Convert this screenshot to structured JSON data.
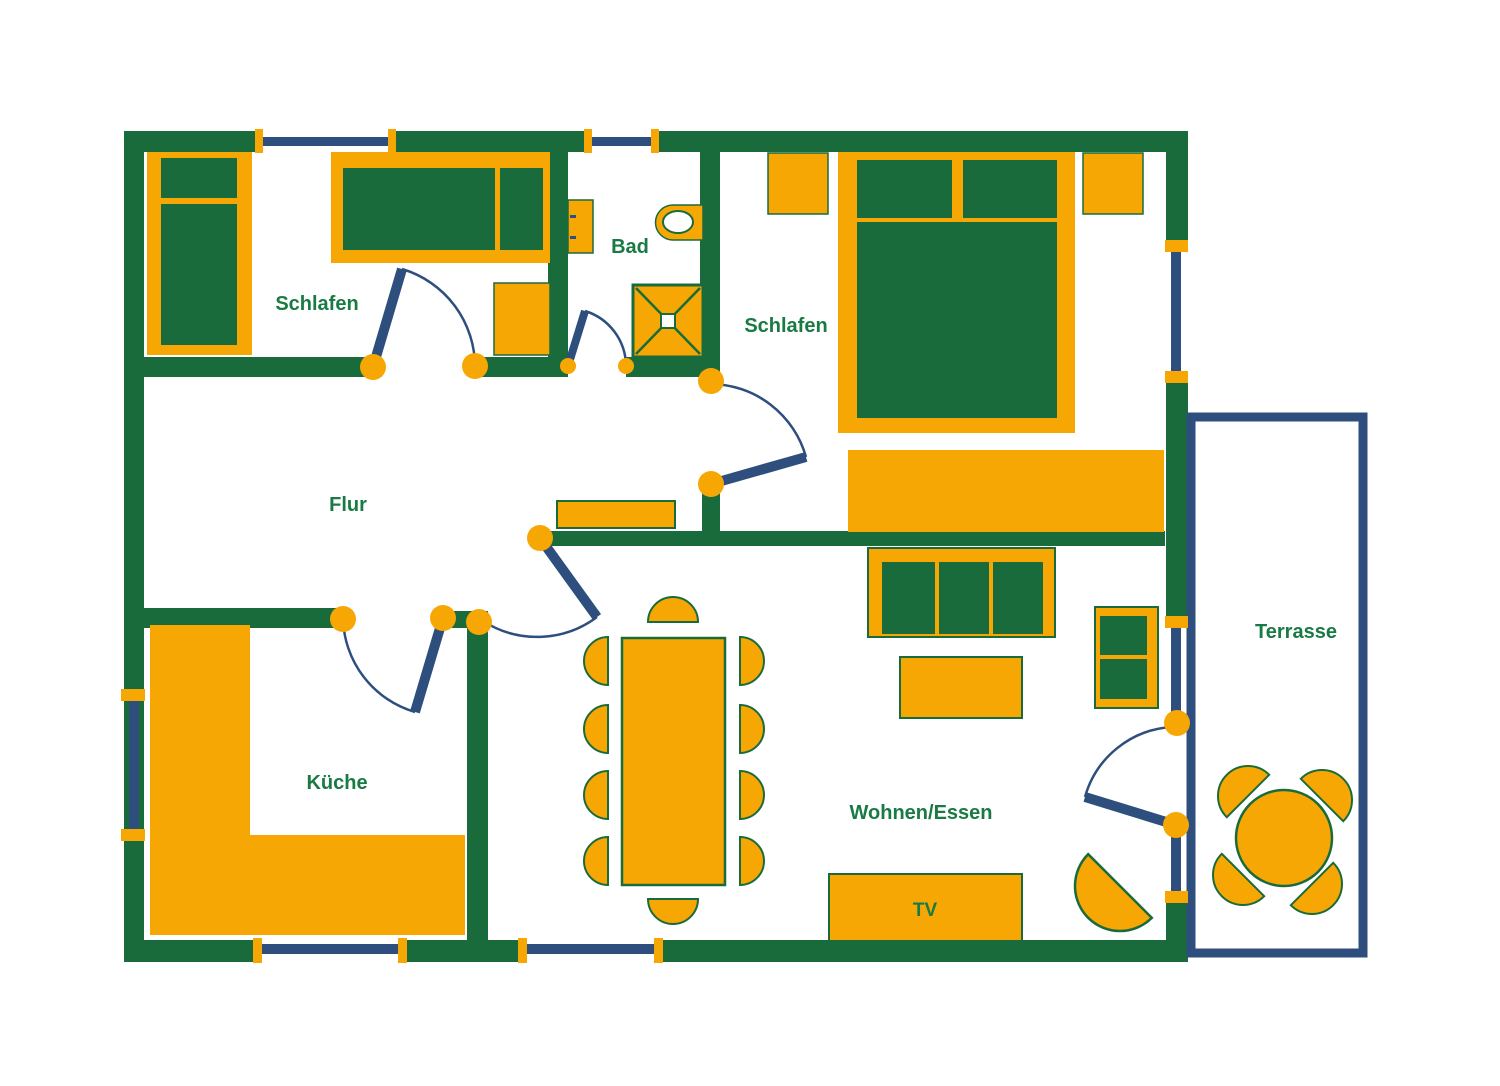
{
  "colors": {
    "wall": "#1A6B3C",
    "text": "#1A7A44",
    "furniture": "#F6A704",
    "window": "#2E4F7E",
    "background": "#FFFFFF"
  },
  "rooms": [
    {
      "name": "schlafen-1",
      "label": "Schlafen",
      "x": 317,
      "y": 310
    },
    {
      "name": "bad",
      "label": "Bad",
      "x": 630,
      "y": 253
    },
    {
      "name": "schlafen-2",
      "label": "Schlafen",
      "x": 786,
      "y": 332
    },
    {
      "name": "flur",
      "label": "Flur",
      "x": 348,
      "y": 511
    },
    {
      "name": "kueche",
      "label": "Küche",
      "x": 337,
      "y": 789
    },
    {
      "name": "wohnen-essen",
      "label": "Wohnen/Essen",
      "x": 921,
      "y": 819
    },
    {
      "name": "terrasse",
      "label": "Terrasse",
      "x": 1296,
      "y": 638
    },
    {
      "name": "tv",
      "label": "TV",
      "x": 925,
      "y": 916,
      "size": 19
    }
  ],
  "walls": [
    {
      "name": "wall-top-1",
      "x": 124,
      "y": 131,
      "w": 131,
      "h": 21
    },
    {
      "name": "wall-top-2",
      "x": 396,
      "y": 131,
      "w": 188,
      "h": 21
    },
    {
      "name": "wall-top-3",
      "x": 659,
      "y": 131,
      "w": 529,
      "h": 21
    },
    {
      "name": "wall-left",
      "x": 124,
      "y": 131,
      "w": 20,
      "h": 831
    },
    {
      "name": "wall-right-1",
      "x": 1166,
      "y": 131,
      "w": 22,
      "h": 109
    },
    {
      "name": "wall-right-2",
      "x": 1166,
      "y": 382,
      "w": 22,
      "h": 234
    },
    {
      "name": "wall-right-3",
      "x": 1166,
      "y": 902,
      "w": 22,
      "h": 60
    },
    {
      "name": "wall-bottom-1",
      "x": 124,
      "y": 940,
      "w": 132,
      "h": 22
    },
    {
      "name": "wall-bottom-2",
      "x": 404,
      "y": 940,
      "w": 116,
      "h": 22
    },
    {
      "name": "wall-bottom-3",
      "x": 661,
      "y": 940,
      "w": 527,
      "h": 22
    },
    {
      "name": "wall-bath-left",
      "x": 548,
      "y": 152,
      "w": 20,
      "h": 225
    },
    {
      "name": "wall-bath-right",
      "x": 700,
      "y": 152,
      "w": 20,
      "h": 229
    },
    {
      "name": "wall-schlafen1-bottom-1",
      "x": 144,
      "y": 357,
      "w": 229,
      "h": 20
    },
    {
      "name": "wall-schlafen1-bottom-2",
      "x": 475,
      "y": 357,
      "w": 93,
      "h": 20
    },
    {
      "name": "wall-bad-bottom",
      "x": 626,
      "y": 357,
      "w": 74,
      "h": 20
    },
    {
      "name": "wall-schlafen2-stub",
      "x": 702,
      "y": 488,
      "w": 18,
      "h": 44
    },
    {
      "name": "wall-flur-wohnen",
      "x": 545,
      "y": 531,
      "w": 620,
      "h": 15
    },
    {
      "name": "wall-kueche-top-1",
      "x": 144,
      "y": 608,
      "w": 199,
      "h": 20
    },
    {
      "name": "wall-kueche-top-2",
      "x": 443,
      "y": 611,
      "w": 45,
      "h": 17
    },
    {
      "name": "wall-kueche-right",
      "x": 467,
      "y": 611,
      "w": 21,
      "h": 329
    }
  ],
  "terrace_outline": {
    "name": "terrasse-outline",
    "x": 1191,
    "y": 417,
    "w": 172,
    "h": 536,
    "sw": 9
  },
  "windows": [
    {
      "name": "window-top-schlafen1",
      "caps": [
        [
          255,
          129,
          8,
          24
        ],
        [
          388,
          129,
          8,
          24
        ]
      ],
      "line": [
        263,
        137,
        125,
        9
      ]
    },
    {
      "name": "window-top-bad",
      "caps": [
        [
          584,
          129,
          8,
          24
        ],
        [
          651,
          129,
          8,
          24
        ]
      ],
      "line": [
        592,
        137,
        59,
        9
      ]
    },
    {
      "name": "window-left-kueche",
      "caps": [
        [
          121,
          689,
          24,
          12
        ],
        [
          121,
          829,
          24,
          12
        ]
      ],
      "line": [
        129,
        701,
        10,
        128
      ]
    },
    {
      "name": "window-right-schlafen2",
      "caps": [
        [
          1165,
          240,
          23,
          12
        ],
        [
          1165,
          371,
          23,
          12
        ]
      ],
      "line": [
        1171,
        252,
        10,
        119
      ]
    },
    {
      "name": "window-right-wohnen-upper",
      "caps": [
        [
          1165,
          616,
          23,
          12
        ]
      ],
      "line": [
        1171,
        628,
        10,
        88
      ]
    },
    {
      "name": "window-right-wohnen-lower",
      "caps": [
        [
          1165,
          891,
          23,
          12
        ]
      ],
      "line": [
        1171,
        833,
        10,
        58
      ]
    },
    {
      "name": "window-bottom-kueche",
      "caps": [
        [
          253,
          938,
          9,
          25
        ],
        [
          398,
          938,
          9,
          25
        ]
      ],
      "line": [
        262,
        944,
        136,
        10
      ]
    },
    {
      "name": "window-bottom-wohnen",
      "caps": [
        [
          518,
          938,
          9,
          25
        ],
        [
          654,
          938,
          9,
          25
        ]
      ],
      "line": [
        527,
        944,
        127,
        10
      ]
    }
  ],
  "doors": [
    {
      "name": "door-schlafen1",
      "leaf": [
        373,
        367,
        402,
        269
      ],
      "arc": "M 402 269 A 102 102 0 0 1 475 367",
      "circles": [
        [
          373,
          367,
          13
        ],
        [
          475,
          366,
          13
        ]
      ],
      "lw": 10
    },
    {
      "name": "door-bad",
      "leaf": [
        568,
        366,
        585,
        311
      ],
      "arc": "M 585 311 A 58 58 0 0 1 626 366",
      "circles": [
        [
          568,
          366,
          8
        ],
        [
          626,
          366,
          8
        ]
      ],
      "lw": 8
    },
    {
      "name": "door-schlafen2",
      "leaf": [
        711,
        484,
        806,
        457
      ],
      "arc": "M 711 384 A 100 100 0 0 1 806 457",
      "circles": [
        [
          711,
          381,
          13
        ],
        [
          711,
          484,
          13
        ]
      ],
      "lw": 10
    },
    {
      "name": "door-kueche",
      "leaf": [
        443,
        618,
        415,
        712
      ],
      "arc": "M 343 618 A 100 100 0 0 0 415 712",
      "circles": [
        [
          343,
          619,
          13
        ],
        [
          443,
          618,
          13
        ]
      ],
      "lw": 10
    },
    {
      "name": "door-flur-wohnen",
      "leaf": [
        540,
        538,
        597,
        617
      ],
      "arc": "M 597 617 A 100 100 0 0 1 483 621",
      "circles": [
        [
          540,
          538,
          13
        ],
        [
          479,
          622,
          13
        ]
      ],
      "lw": 10
    },
    {
      "name": "door-terrasse",
      "leaf": [
        1176,
        825,
        1085,
        797
      ],
      "arc": "M 1085 797 A 96 96 0 0 1 1172 727",
      "circles": [
        [
          1177,
          723,
          13
        ],
        [
          1176,
          825,
          13
        ]
      ],
      "lw": 10
    }
  ],
  "furniture": [
    {
      "name": "wardrobe",
      "type": "rect",
      "x": 147,
      "y": 152,
      "w": 105,
      "h": 203,
      "fill": "furniture"
    },
    {
      "name": "wardrobe-door-top",
      "type": "rect",
      "x": 161,
      "y": 158,
      "w": 76,
      "h": 40,
      "fill": "wall"
    },
    {
      "name": "wardrobe-door-bottom",
      "type": "rect",
      "x": 161,
      "y": 204,
      "w": 76,
      "h": 141,
      "fill": "wall"
    },
    {
      "name": "bed-single-frame",
      "type": "rect",
      "x": 331,
      "y": 152,
      "w": 219,
      "h": 111,
      "fill": "furniture"
    },
    {
      "name": "bed-single-mattress",
      "type": "rect",
      "x": 343,
      "y": 168,
      "w": 152,
      "h": 82,
      "fill": "wall"
    },
    {
      "name": "bed-single-pillow",
      "type": "rect",
      "x": 500,
      "y": 168,
      "w": 43,
      "h": 82,
      "fill": "wall"
    },
    {
      "name": "nightstand-schlafen1",
      "type": "rect",
      "x": 494,
      "y": 283,
      "w": 56,
      "h": 72,
      "fill": "furniture",
      "stroke": "wall",
      "sw": 1.5
    },
    {
      "name": "bath-sink",
      "type": "rect",
      "x": 568,
      "y": 200,
      "w": 25,
      "h": 53,
      "fill": "furniture",
      "stroke": "wall",
      "sw": 1.5
    },
    {
      "name": "bath-sink-handle-1",
      "type": "rect",
      "x": 570,
      "y": 215,
      "w": 6,
      "h": 3,
      "fill": "window"
    },
    {
      "name": "bath-sink-handle-2",
      "type": "rect",
      "x": 570,
      "y": 236,
      "w": 6,
      "h": 3,
      "fill": "window"
    },
    {
      "name": "toilet",
      "type": "path",
      "d": "M 703 205 L 673 205 A 17.5 17.5 0 0 0 673 240 L 703 240 Z",
      "fill": "furniture",
      "stroke": "wall",
      "sw": 1.5
    },
    {
      "name": "toilet-bowl",
      "type": "ellipse",
      "cx": 678,
      "cy": 222,
      "rx": 15,
      "ry": 11,
      "fill": "background",
      "stroke": "wall",
      "sw": 2
    },
    {
      "name": "shower",
      "type": "rect",
      "x": 633,
      "y": 285,
      "w": 70,
      "h": 72,
      "fill": "furniture",
      "stroke": "wall",
      "sw": 3
    },
    {
      "name": "shower-diagonal-1",
      "type": "line",
      "x1": 636,
      "y1": 288,
      "x2": 700,
      "y2": 354,
      "stroke": "wall",
      "sw": 2.5
    },
    {
      "name": "shower-diagonal-2",
      "type": "line",
      "x1": 700,
      "y1": 288,
      "x2": 636,
      "y2": 354,
      "stroke": "wall",
      "sw": 2.5
    },
    {
      "name": "shower-drain",
      "type": "rect",
      "x": 661,
      "y": 314,
      "w": 14,
      "h": 14,
      "fill": "background",
      "stroke": "wall",
      "sw": 2
    },
    {
      "name": "nightstand-schlafen2-left",
      "type": "rect",
      "x": 768,
      "y": 153,
      "w": 60,
      "h": 61,
      "fill": "furniture",
      "stroke": "wall",
      "sw": 1.5
    },
    {
      "name": "nightstand-schlafen2-right",
      "type": "rect",
      "x": 1083,
      "y": 153,
      "w": 60,
      "h": 61,
      "fill": "furniture",
      "stroke": "wall",
      "sw": 1.5
    },
    {
      "name": "bed-double-frame",
      "type": "rect",
      "x": 838,
      "y": 152,
      "w": 237,
      "h": 281,
      "fill": "furniture"
    },
    {
      "name": "bed-double-pillow-left",
      "type": "rect",
      "x": 857,
      "y": 160,
      "w": 95,
      "h": 58,
      "fill": "wall"
    },
    {
      "name": "bed-double-pillow-right",
      "type": "rect",
      "x": 963,
      "y": 160,
      "w": 94,
      "h": 58,
      "fill": "wall"
    },
    {
      "name": "bed-double-mattress",
      "type": "rect",
      "x": 857,
      "y": 222,
      "w": 200,
      "h": 196,
      "fill": "wall"
    },
    {
      "name": "dresser-schlafen2",
      "type": "rect",
      "x": 848,
      "y": 450,
      "w": 316,
      "h": 82,
      "fill": "furniture"
    },
    {
      "name": "sideboard-flur",
      "type": "rect",
      "x": 557,
      "y": 501,
      "w": 118,
      "h": 27,
      "fill": "furniture",
      "stroke": "wall",
      "sw": 2
    },
    {
      "name": "kitchen-counter-left",
      "type": "rect",
      "x": 150,
      "y": 625,
      "w": 100,
      "h": 310,
      "fill": "furniture"
    },
    {
      "name": "kitchen-counter-bottom",
      "type": "rect",
      "x": 150,
      "y": 835,
      "w": 315,
      "h": 100,
      "fill": "furniture"
    },
    {
      "name": "dining-table",
      "type": "rect",
      "x": 622,
      "y": 638,
      "w": 103,
      "h": 247,
      "fill": "furniture",
      "stroke": "wall",
      "sw": 2.5
    },
    {
      "name": "dining-chair-top",
      "type": "semicircle",
      "cx": 673,
      "cy": 622,
      "r": 25,
      "rot": 0,
      "fill": "furniture",
      "stroke": "wall",
      "sw": 2
    },
    {
      "name": "dining-chair-bottom",
      "type": "semicircle",
      "cx": 673,
      "cy": 899,
      "r": 25,
      "rot": 180,
      "fill": "furniture",
      "stroke": "wall",
      "sw": 2
    },
    {
      "name": "dining-chair-left-1",
      "type": "semicircle",
      "cx": 608,
      "cy": 661,
      "r": 24,
      "rot": -90,
      "fill": "furniture",
      "stroke": "wall",
      "sw": 2
    },
    {
      "name": "dining-chair-left-2",
      "type": "semicircle",
      "cx": 608,
      "cy": 729,
      "r": 24,
      "rot": -90,
      "fill": "furniture",
      "stroke": "wall",
      "sw": 2
    },
    {
      "name": "dining-chair-left-3",
      "type": "semicircle",
      "cx": 608,
      "cy": 795,
      "r": 24,
      "rot": -90,
      "fill": "furniture",
      "stroke": "wall",
      "sw": 2
    },
    {
      "name": "dining-chair-left-4",
      "type": "semicircle",
      "cx": 608,
      "cy": 861,
      "r": 24,
      "rot": -90,
      "fill": "furniture",
      "stroke": "wall",
      "sw": 2
    },
    {
      "name": "dining-chair-right-1",
      "type": "semicircle",
      "cx": 740,
      "cy": 661,
      "r": 24,
      "rot": 90,
      "fill": "furniture",
      "stroke": "wall",
      "sw": 2
    },
    {
      "name": "dining-chair-right-2",
      "type": "semicircle",
      "cx": 740,
      "cy": 729,
      "r": 24,
      "rot": 90,
      "fill": "furniture",
      "stroke": "wall",
      "sw": 2
    },
    {
      "name": "dining-chair-right-3",
      "type": "semicircle",
      "cx": 740,
      "cy": 795,
      "r": 24,
      "rot": 90,
      "fill": "furniture",
      "stroke": "wall",
      "sw": 2
    },
    {
      "name": "dining-chair-right-4",
      "type": "semicircle",
      "cx": 740,
      "cy": 861,
      "r": 24,
      "rot": 90,
      "fill": "furniture",
      "stroke": "wall",
      "sw": 2
    },
    {
      "name": "sofa-frame",
      "type": "rect",
      "x": 868,
      "y": 548,
      "w": 187,
      "h": 89,
      "fill": "furniture",
      "stroke": "wall",
      "sw": 2
    },
    {
      "name": "sofa-seat",
      "type": "rect",
      "x": 882,
      "y": 562,
      "w": 161,
      "h": 72,
      "fill": "wall"
    },
    {
      "name": "sofa-divider-1",
      "type": "rect",
      "x": 935,
      "y": 562,
      "w": 4,
      "h": 72,
      "fill": "furniture"
    },
    {
      "name": "sofa-divider-2",
      "type": "rect",
      "x": 989,
      "y": 562,
      "w": 4,
      "h": 72,
      "fill": "furniture"
    },
    {
      "name": "coffee-table",
      "type": "rect",
      "x": 900,
      "y": 657,
      "w": 122,
      "h": 61,
      "fill": "furniture",
      "stroke": "wall",
      "sw": 2
    },
    {
      "name": "armchair-frame",
      "type": "rect",
      "x": 1095,
      "y": 607,
      "w": 63,
      "h": 101,
      "fill": "furniture",
      "stroke": "wall",
      "sw": 2
    },
    {
      "name": "armchair-seat",
      "type": "rect",
      "x": 1100,
      "y": 616,
      "w": 47,
      "h": 83,
      "fill": "wall"
    },
    {
      "name": "armchair-divider",
      "type": "rect",
      "x": 1100,
      "y": 655,
      "w": 47,
      "h": 4,
      "fill": "furniture"
    },
    {
      "name": "tv-board",
      "type": "rect",
      "x": 829,
      "y": 874,
      "w": 193,
      "h": 67,
      "fill": "furniture",
      "stroke": "wall",
      "sw": 2
    },
    {
      "name": "plant",
      "type": "semicircle",
      "cx": 1120,
      "cy": 886,
      "r": 45,
      "rot": -135,
      "fill": "furniture",
      "stroke": "wall",
      "sw": 2.5
    },
    {
      "name": "terrace-table",
      "type": "circle",
      "cx": 1284,
      "cy": 838,
      "r": 48,
      "fill": "furniture",
      "stroke": "wall",
      "sw": 2.5
    },
    {
      "name": "terrace-chair-nw",
      "type": "semicircle",
      "cx": 1248,
      "cy": 796,
      "r": 30,
      "rot": -45,
      "fill": "furniture",
      "stroke": "wall",
      "sw": 2
    },
    {
      "name": "terrace-chair-ne",
      "type": "semicircle",
      "cx": 1322,
      "cy": 800,
      "r": 30,
      "rot": 45,
      "fill": "furniture",
      "stroke": "wall",
      "sw": 2
    },
    {
      "name": "terrace-chair-sw",
      "type": "semicircle",
      "cx": 1243,
      "cy": 875,
      "r": 30,
      "rot": -135,
      "fill": "furniture",
      "stroke": "wall",
      "sw": 2
    },
    {
      "name": "terrace-chair-se",
      "type": "semicircle",
      "cx": 1312,
      "cy": 884,
      "r": 30,
      "rot": 135,
      "fill": "furniture",
      "stroke": "wall",
      "sw": 2
    }
  ]
}
